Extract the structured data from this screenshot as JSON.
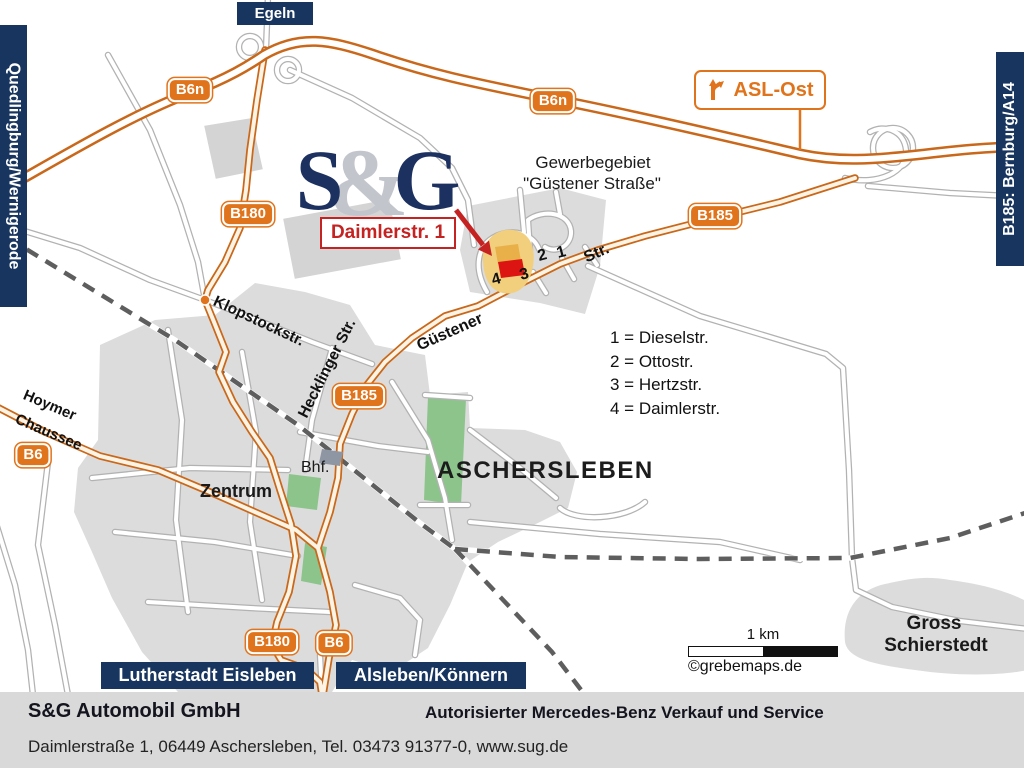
{
  "map": {
    "destinations": {
      "top": "Egeln",
      "left": "Quedlingburg/Wernigerode",
      "right": "B185: Bernburg/A14",
      "bottom_left": "Lutherstadt Eisleben",
      "bottom_right": "Alsleben/Könnern"
    },
    "badges": {
      "b6n": "B6n",
      "b180": "B180",
      "b185": "B185",
      "b6": "B6"
    },
    "exit": {
      "label": "ASL-Ost"
    },
    "logo": {
      "s": "S",
      "amp": "&",
      "g": "G"
    },
    "address_flag": "Daimlerstr. 1",
    "industrial_area": {
      "line1": "Gewerbegebiet",
      "line2": "\"Güstener Straße\""
    },
    "streets": {
      "klopstock": "Klopstockstr.",
      "hecklinger": "Hecklinger  Str.",
      "guestener": "Güstener",
      "guestener_str": "Str.",
      "hoymer_line1": "Hoymer",
      "hoymer_line2": "Chaussee"
    },
    "site_numbers": [
      "4",
      "3",
      "2",
      "1"
    ],
    "legend": {
      "items": [
        "1 = Dieselstr.",
        "2 = Ottostr.",
        "3 = Hertzstr.",
        "4 = Daimlerstr."
      ]
    },
    "city": "ASCHERSLEBEN",
    "zentrum": "Zentrum",
    "bhf": "Bhf.",
    "gross": {
      "line1": "Gross",
      "line2": "Schierstedt"
    },
    "scale": {
      "label": "1 km",
      "credit": "©grebemaps.de"
    }
  },
  "footer": {
    "company": "S&G Automobil GmbH",
    "tagline": "Autorisierter Mercedes-Benz Verkauf und Service",
    "address": "Daimlerstraße 1, 06449 Aschersleben, Tel. 03473 91377-0, www.sug.de"
  },
  "colors": {
    "navy": "#17355e",
    "orange": "#e0741c",
    "red": "#c52222",
    "site_yellow": "#f2cf7d",
    "site_red": "#dd1512",
    "green": "#8cc48c",
    "urban_gray": "#dcdcdc"
  }
}
